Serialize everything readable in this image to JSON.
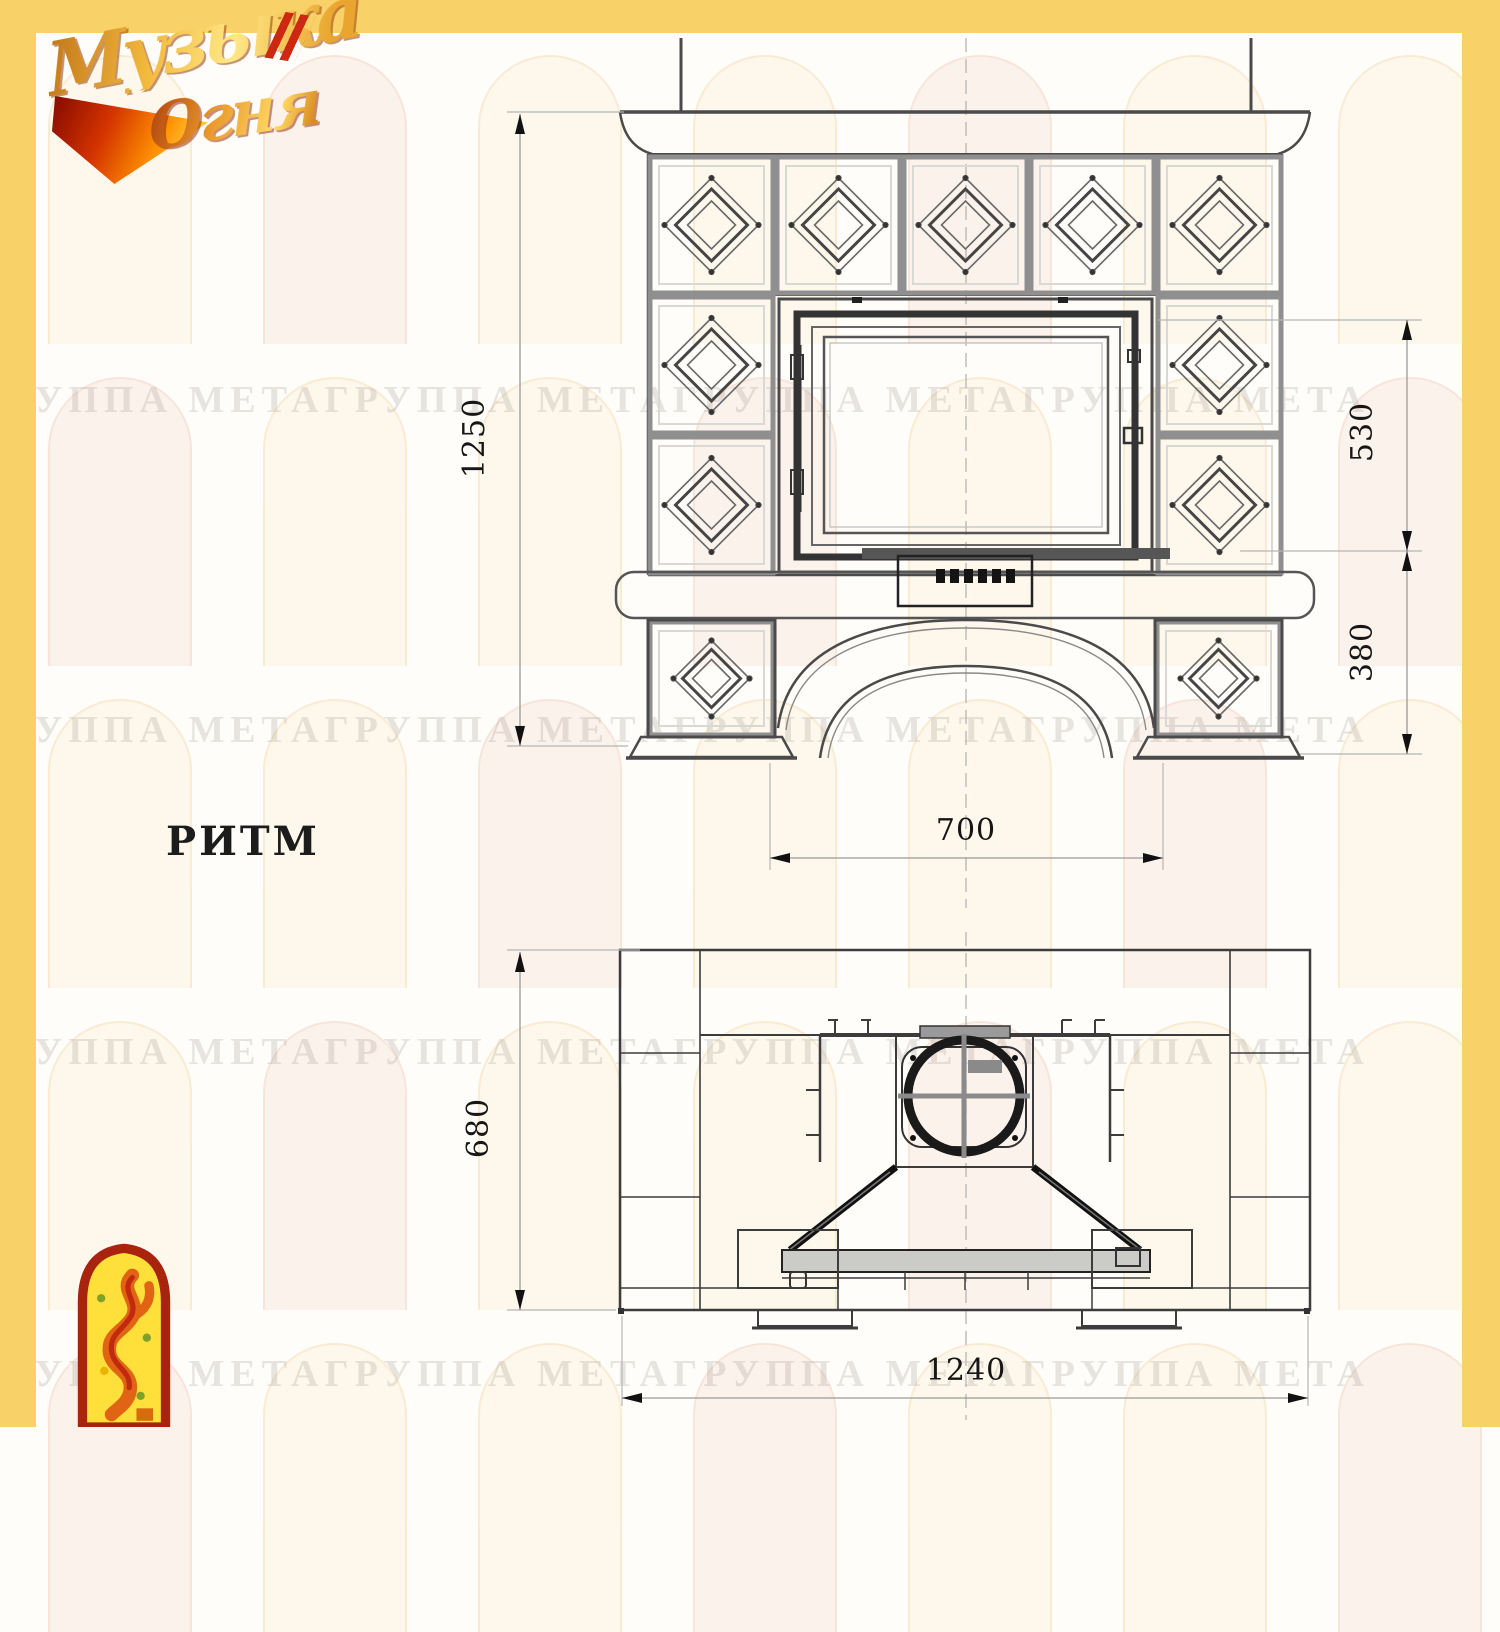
{
  "logo": {
    "word1": "Музыка",
    "word2": "Огня"
  },
  "title": {
    "model": "РИТМ"
  },
  "dimensions": {
    "front_total_height": "1250",
    "firebox_zone_height": "530",
    "base_zone_height": "380",
    "portal_width": "700",
    "plan_depth": "680",
    "plan_width": "1240"
  },
  "watermark": {
    "text": "ГРУППА МЕТАГРУППА МЕТАГРУППА МЕТАГРУППА МЕТА"
  },
  "colors": {
    "accent_band": "#F8D268",
    "drawing_line": "#3C3C3C",
    "dimension_text": "#161616",
    "emblem_red": "#A8240F",
    "emblem_yellow": "#FFDF3A"
  }
}
